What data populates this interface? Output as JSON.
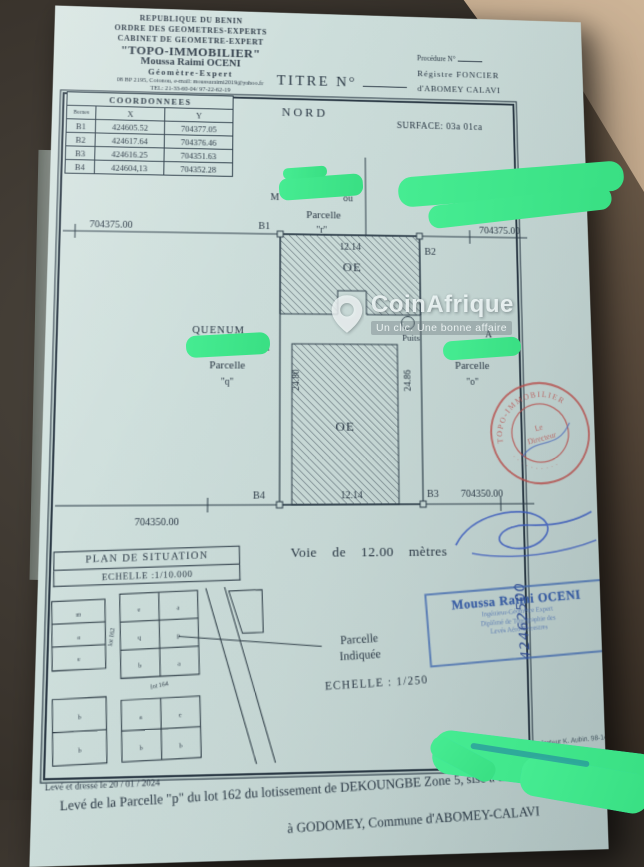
{
  "watermark": {
    "brand": "CoinAfrique",
    "tagline": "Un clic. Une bonne affaire"
  },
  "header": {
    "org_lines": [
      "REPUBLIQUE DU BENIN",
      "ORDRE DES GEOMETRES-EXPERTS",
      "CABINET DE GEOMETRE-EXPERT",
      "\"TOPO-IMMOBILIER\"",
      "Moussa Raimi OCENI",
      "Géomètre-Expert",
      "08 BP 2195, Cotonou, e-mail: moussaraimi2019@yahoo.fr",
      "TEL: 21-33-60-04/ 97-22-62-19"
    ],
    "title": "TITRE N°",
    "right_lines": [
      "Procédure N°",
      "Régistre FONCIER",
      "d'ABOMEY CALAVI"
    ]
  },
  "plan": {
    "north": "NORD",
    "surface": "SURFACE: 03a 01ca",
    "coords": {
      "title": "COORDONNEES",
      "headers": [
        "Bornes",
        "X",
        "Y"
      ],
      "rows": [
        [
          "B1",
          "424605.52",
          "704377.05"
        ],
        [
          "B2",
          "424617.64",
          "704376.46"
        ],
        [
          "B3",
          "424616.25",
          "704351.63"
        ],
        [
          "B4",
          "424604,13",
          "704352.28"
        ]
      ]
    },
    "northing_top": "704375.00",
    "northing_bottom": "704350.00",
    "corners": {
      "b1": "B1",
      "b2": "B2",
      "b3": "B3",
      "b4": "B4"
    },
    "dims": {
      "top": "12.14",
      "bottom": "12.14",
      "left": "24.80",
      "right": "24.86"
    },
    "zone_top": "OE",
    "zone_bottom": "OE",
    "well": "Puits",
    "neighbors": {
      "top_left": {
        "pre": "M",
        "post": "ou",
        "line": "Parcelle",
        "id": "\"r\""
      },
      "top_right": {
        "id": "\"n\""
      },
      "left": {
        "name": "QUENUM",
        "post": "u",
        "line": "Parcelle",
        "id": "\"q\""
      },
      "right": {
        "post": "A",
        "line": "Parcelle",
        "id": "\"o\""
      }
    },
    "road": "Voie de 12.00 mètres"
  },
  "situation": {
    "title": "PLAN DE SITUATION",
    "scale": "ECHELLE :1/10.000",
    "lot_a": "lot 162",
    "lot_b": "lot 164",
    "cells_a": [
      "m",
      "a",
      "e"
    ],
    "cells_b": [
      "e",
      "a",
      "q",
      "p",
      "b",
      "a"
    ],
    "cells_d": [
      "b",
      "b"
    ],
    "cells_e": [
      "a",
      "e",
      "b",
      "b"
    ],
    "pointer_line1": "Parcelle",
    "pointer_line2": "Indiquée"
  },
  "stamps": {
    "round": {
      "ring": "TOPO-IMMOBILIER",
      "ring2": "· · · · · · · · · ·",
      "center1": "Le",
      "center2": "Directeur"
    },
    "blue": {
      "name": "Moussa Raimi OCENI",
      "sub": [
        "Ingénieur-Géomètre Expert",
        "Diplômé de Topographie des",
        "Levés Aéro-Terrestres"
      ],
      "number": "42462500"
    }
  },
  "footer": {
    "scale": "ECHELLE : 1/250",
    "operator": "Relevés par l'Opérateur K. Aubin. 98-14-18",
    "date": "Levé et dressé le 20 / 01 / 2024",
    "line1": "Levé de la Parcelle \"p\" du lot 162 du lotissement de DEKOUNGBE Zone 5, sise à DEKOUNGBE,",
    "line2": "à GODOMEY, Commune d'ABOMEY-CALAVI"
  }
}
